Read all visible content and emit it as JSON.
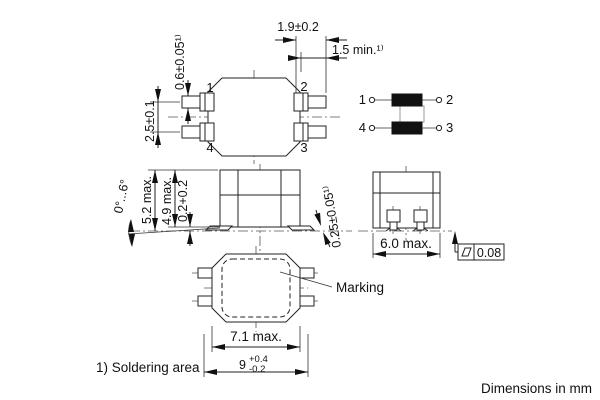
{
  "meta": {
    "footnote": "1) Soldering area",
    "units_note": "Dimensions in mm"
  },
  "top_view": {
    "pins": {
      "p1": "1",
      "p2": "2",
      "p3": "3",
      "p4": "4"
    },
    "dims": {
      "pin_length": "1.9±0.2",
      "solder_len_min": "1.5 min.¹⁾",
      "pin_width": "0.6±0.05¹⁾",
      "pin_pitch": "2.5±0.1"
    }
  },
  "schematic": {
    "pins": {
      "p1": "1",
      "p2": "2",
      "p3": "3",
      "p4": "4"
    }
  },
  "front_view": {
    "dims": {
      "tilt_angle": "0°...6°",
      "height_max": "5.2 max.",
      "body_height_max": "4.9 max.",
      "standoff": "0.2+0.2",
      "terminal_thickness": "0.25±0.05¹⁾"
    }
  },
  "side_view": {
    "dims": {
      "width_max": "6.0 max.",
      "coplanarity": "0.08"
    }
  },
  "bottom_view": {
    "marking_label": "Marking",
    "dims": {
      "body_width_max": "7.1 max.",
      "overall_width": "9",
      "overall_tol_plus": "+0.4",
      "overall_tol_minus": "-0.2"
    }
  }
}
